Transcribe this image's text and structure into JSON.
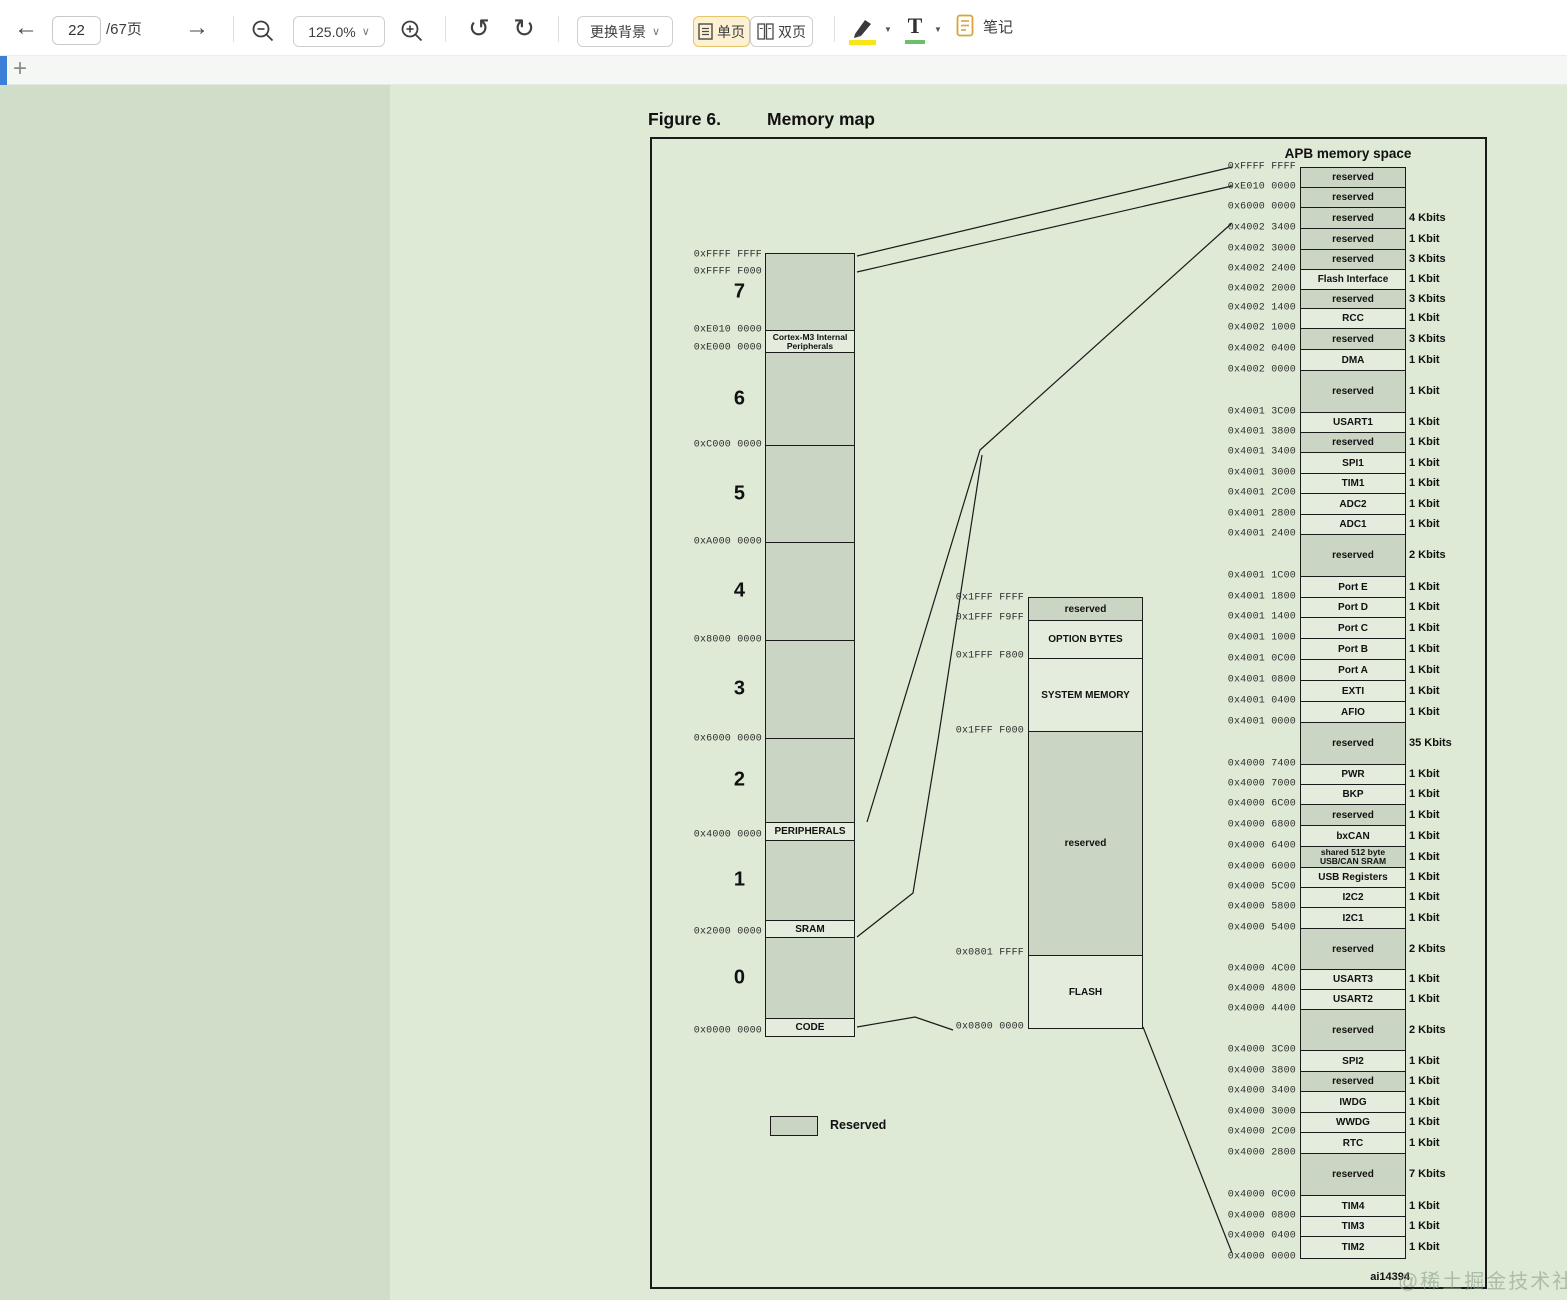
{
  "toolbar": {
    "page_value": "22",
    "page_total": "/67页",
    "zoom_value": "125.0%",
    "background_button": "更换背景",
    "single_page": "单页",
    "double_page": "双页",
    "notes": "笔记"
  },
  "icons": {
    "back": "←",
    "forward": "→",
    "undo": "↺",
    "redo": "↻",
    "plus_tab": "+",
    "chevron_down": "∨",
    "caret_down": "▼"
  },
  "colors": {
    "accent_blue": "#3c7fd9",
    "active_btn_bg": "#fcf1d2",
    "active_btn_border": "#e7c469",
    "highlight_yellow": "#f7e518",
    "text_tool_green": "#6abf69",
    "note_orange": "#d9a43b",
    "viewer_bg": "#cfddc9",
    "page_bg": "#dee9d6",
    "block_shaded": "#cad5c3",
    "block_light": "#e4ecde",
    "line": "#1a1a1a"
  },
  "figure": {
    "title_prefix": "Figure 6.",
    "title": "Memory map",
    "apb_header": "APB memory space",
    "legend_label": "Reserved",
    "figure_id": "ai14394",
    "watermark": "@稀土掘金技术社区"
  },
  "main_map": {
    "segments": [
      {
        "h": 77,
        "res": true,
        "num": "7"
      },
      {
        "h": 22,
        "res": false,
        "label": "Cortex-M3 Internal Peripherals",
        "small": true
      },
      {
        "h": 93,
        "res": true,
        "num": "6"
      },
      {
        "h": 97,
        "res": true,
        "num": "5"
      },
      {
        "h": 98,
        "res": true,
        "num": "4"
      },
      {
        "h": 98,
        "res": true,
        "num": "3"
      },
      {
        "h": 84,
        "res": true,
        "num": "2"
      },
      {
        "h": 18,
        "res": false,
        "label": "PERIPHERALS"
      },
      {
        "h": 80,
        "res": true,
        "num": "1"
      },
      {
        "h": 17,
        "res": false,
        "label": "SRAM"
      },
      {
        "h": 81,
        "res": true,
        "num": "0"
      },
      {
        "h": 17,
        "res": false,
        "label": "CODE"
      }
    ],
    "address_labels": [
      {
        "text": "0xFFFF FFFF",
        "y": 255
      },
      {
        "text": "0xFFFF F000",
        "y": 272
      },
      {
        "text": "0xE010 0000",
        "y": 330
      },
      {
        "text": "0xE000 0000",
        "y": 348
      },
      {
        "text": "0xC000 0000",
        "y": 445
      },
      {
        "text": "0xA000 0000",
        "y": 542
      },
      {
        "text": "0x8000 0000",
        "y": 640
      },
      {
        "text": "0x6000 0000",
        "y": 739
      },
      {
        "text": "0x4000 0000",
        "y": 835
      },
      {
        "text": "0x2000 0000",
        "y": 932
      },
      {
        "text": "0x0000 0000",
        "y": 1031
      }
    ]
  },
  "code_map": {
    "segments": [
      {
        "h": 23,
        "res": true,
        "label": "reserved"
      },
      {
        "h": 38,
        "res": false,
        "label": "OPTION BYTES"
      },
      {
        "h": 73,
        "res": false,
        "label": "SYSTEM MEMORY"
      },
      {
        "h": 224,
        "res": true,
        "label": "reserved"
      },
      {
        "h": 72,
        "res": false,
        "label": "FLASH"
      }
    ],
    "address_labels": [
      {
        "text": "0x1FFF FFFF",
        "y": 598
      },
      {
        "text": "0x1FFF F9FF",
        "y": 618
      },
      {
        "text": "0x1FFF F800",
        "y": 656
      },
      {
        "text": "0x1FFF F000",
        "y": 731
      },
      {
        "text": "0x0801 FFFF",
        "y": 953
      },
      {
        "text": "0x0800 0000",
        "y": 1027
      }
    ]
  },
  "apb_map": {
    "top_address": "0xFFFF FFFF",
    "rows": [
      {
        "name": "reserved",
        "size": "",
        "addr": "0xE010 0000",
        "h": 20,
        "res": true
      },
      {
        "name": "reserved",
        "size": "",
        "addr": "0x6000 0000",
        "h": 20,
        "res": true
      },
      {
        "name": "reserved",
        "size": "4 Kbits",
        "addr": "0x4002 3400",
        "h": 21,
        "res": true
      },
      {
        "name": "reserved",
        "size": "1 Kbit",
        "addr": "0x4002 3000",
        "h": 21,
        "res": true
      },
      {
        "name": "reserved",
        "size": "3 Kbits",
        "addr": "0x4002 2400",
        "h": 20,
        "res": true
      },
      {
        "name": "Flash Interface",
        "size": "1 Kbit",
        "addr": "0x4002 2000",
        "h": 20,
        "res": false
      },
      {
        "name": "reserved",
        "size": "3 Kbits",
        "addr": "0x4002 1400",
        "h": 19,
        "res": true
      },
      {
        "name": "RCC",
        "size": "1 Kbit",
        "addr": "0x4002 1000",
        "h": 20,
        "res": false
      },
      {
        "name": "reserved",
        "size": "3 Kbits",
        "addr": "0x4002 0400",
        "h": 21,
        "res": true
      },
      {
        "name": "DMA",
        "size": "1 Kbit",
        "addr": "0x4002 0000",
        "h": 21,
        "res": false
      },
      {
        "name": "reserved",
        "size": "1 Kbit",
        "addr": "0x4001 3C00",
        "h": 42,
        "res": true
      },
      {
        "name": "USART1",
        "size": "1 Kbit",
        "addr": "0x4001 3800",
        "h": 20,
        "res": false
      },
      {
        "name": "reserved",
        "size": "1 Kbit",
        "addr": "0x4001 3400",
        "h": 20,
        "res": true
      },
      {
        "name": "SPI1",
        "size": "1 Kbit",
        "addr": "0x4001 3000",
        "h": 21,
        "res": false
      },
      {
        "name": "TIM1",
        "size": "1 Kbit",
        "addr": "0x4001 2C00",
        "h": 20,
        "res": false
      },
      {
        "name": "ADC2",
        "size": "1 Kbit",
        "addr": "0x4001 2800",
        "h": 21,
        "res": false
      },
      {
        "name": "ADC1",
        "size": "1 Kbit",
        "addr": "0x4001 2400",
        "h": 20,
        "res": false
      },
      {
        "name": "reserved",
        "size": "2 Kbits",
        "addr": "0x4001 1C00",
        "h": 42,
        "res": true
      },
      {
        "name": "Port E",
        "size": "1 Kbit",
        "addr": "0x4001 1800",
        "h": 21,
        "res": false
      },
      {
        "name": "Port D",
        "size": "1 Kbit",
        "addr": "0x4001 1400",
        "h": 20,
        "res": false
      },
      {
        "name": "Port C",
        "size": "1 Kbit",
        "addr": "0x4001 1000",
        "h": 21,
        "res": false
      },
      {
        "name": "Port B",
        "size": "1 Kbit",
        "addr": "0x4001 0C00",
        "h": 21,
        "res": false
      },
      {
        "name": "Port A",
        "size": "1 Kbit",
        "addr": "0x4001 0800",
        "h": 21,
        "res": false
      },
      {
        "name": "EXTI",
        "size": "1 Kbit",
        "addr": "0x4001 0400",
        "h": 21,
        "res": false
      },
      {
        "name": "AFIO",
        "size": "1 Kbit",
        "addr": "0x4001 0000",
        "h": 21,
        "res": false
      },
      {
        "name": "reserved",
        "size": "35 Kbits",
        "addr": "0x4000 7400",
        "h": 42,
        "res": true
      },
      {
        "name": "PWR",
        "size": "1 Kbit",
        "addr": "0x4000 7000",
        "h": 20,
        "res": false
      },
      {
        "name": "BKP",
        "size": "1 Kbit",
        "addr": "0x4000 6C00",
        "h": 20,
        "res": false
      },
      {
        "name": "reserved",
        "size": "1 Kbit",
        "addr": "0x4000 6800",
        "h": 21,
        "res": true
      },
      {
        "name": "bxCAN",
        "size": "1 Kbit",
        "addr": "0x4000 6400",
        "h": 21,
        "res": false
      },
      {
        "name": "shared 512 byte USB/CAN SRAM",
        "size": "1 Kbit",
        "addr": "0x4000 6000",
        "h": 21,
        "res": true,
        "twoline": true
      },
      {
        "name": "USB Registers",
        "size": "1 Kbit",
        "addr": "0x4000 5C00",
        "h": 20,
        "res": false
      },
      {
        "name": "I2C2",
        "size": "1 Kbit",
        "addr": "0x4000 5800",
        "h": 20,
        "res": false
      },
      {
        "name": "I2C1",
        "size": "1 Kbit",
        "addr": "0x4000 5400",
        "h": 21,
        "res": false
      },
      {
        "name": "reserved",
        "size": "2 Kbits",
        "addr": "0x4000 4C00",
        "h": 41,
        "res": true
      },
      {
        "name": "USART3",
        "size": "1 Kbit",
        "addr": "0x4000 4800",
        "h": 20,
        "res": false
      },
      {
        "name": "USART2",
        "size": "1 Kbit",
        "addr": "0x4000 4400",
        "h": 20,
        "res": false
      },
      {
        "name": "reserved",
        "size": "2 Kbits",
        "addr": "0x4000 3C00",
        "h": 41,
        "res": true
      },
      {
        "name": "SPI2",
        "size": "1 Kbit",
        "addr": "0x4000 3800",
        "h": 21,
        "res": false
      },
      {
        "name": "reserved",
        "size": "1 Kbit",
        "addr": "0x4000 3400",
        "h": 20,
        "res": true
      },
      {
        "name": "IWDG",
        "size": "1 Kbit",
        "addr": "0x4000 3000",
        "h": 21,
        "res": false
      },
      {
        "name": "WWDG",
        "size": "1 Kbit",
        "addr": "0x4000 2C00",
        "h": 20,
        "res": false
      },
      {
        "name": "RTC",
        "size": "1 Kbit",
        "addr": "0x4000 2800",
        "h": 21,
        "res": false
      },
      {
        "name": "reserved",
        "size": "7 Kbits",
        "addr": "0x4000 0C00",
        "h": 42,
        "res": true
      },
      {
        "name": "TIM4",
        "size": "1 Kbit",
        "addr": "0x4000 0800",
        "h": 21,
        "res": false
      },
      {
        "name": "TIM3",
        "size": "1 Kbit",
        "addr": "0x4000 0400",
        "h": 20,
        "res": false
      },
      {
        "name": "TIM2",
        "size": "1 Kbit",
        "addr": "0x4000 0000",
        "h": 21,
        "res": false
      }
    ]
  },
  "connectors": [
    "857,256 1232,167",
    "857,272 1232,186",
    "1232,223 980,450 867,822",
    "982,455 938,740 913,893 857,937",
    "1232,1253 1143,1027",
    "857,1027 915,1017 953,1030"
  ]
}
